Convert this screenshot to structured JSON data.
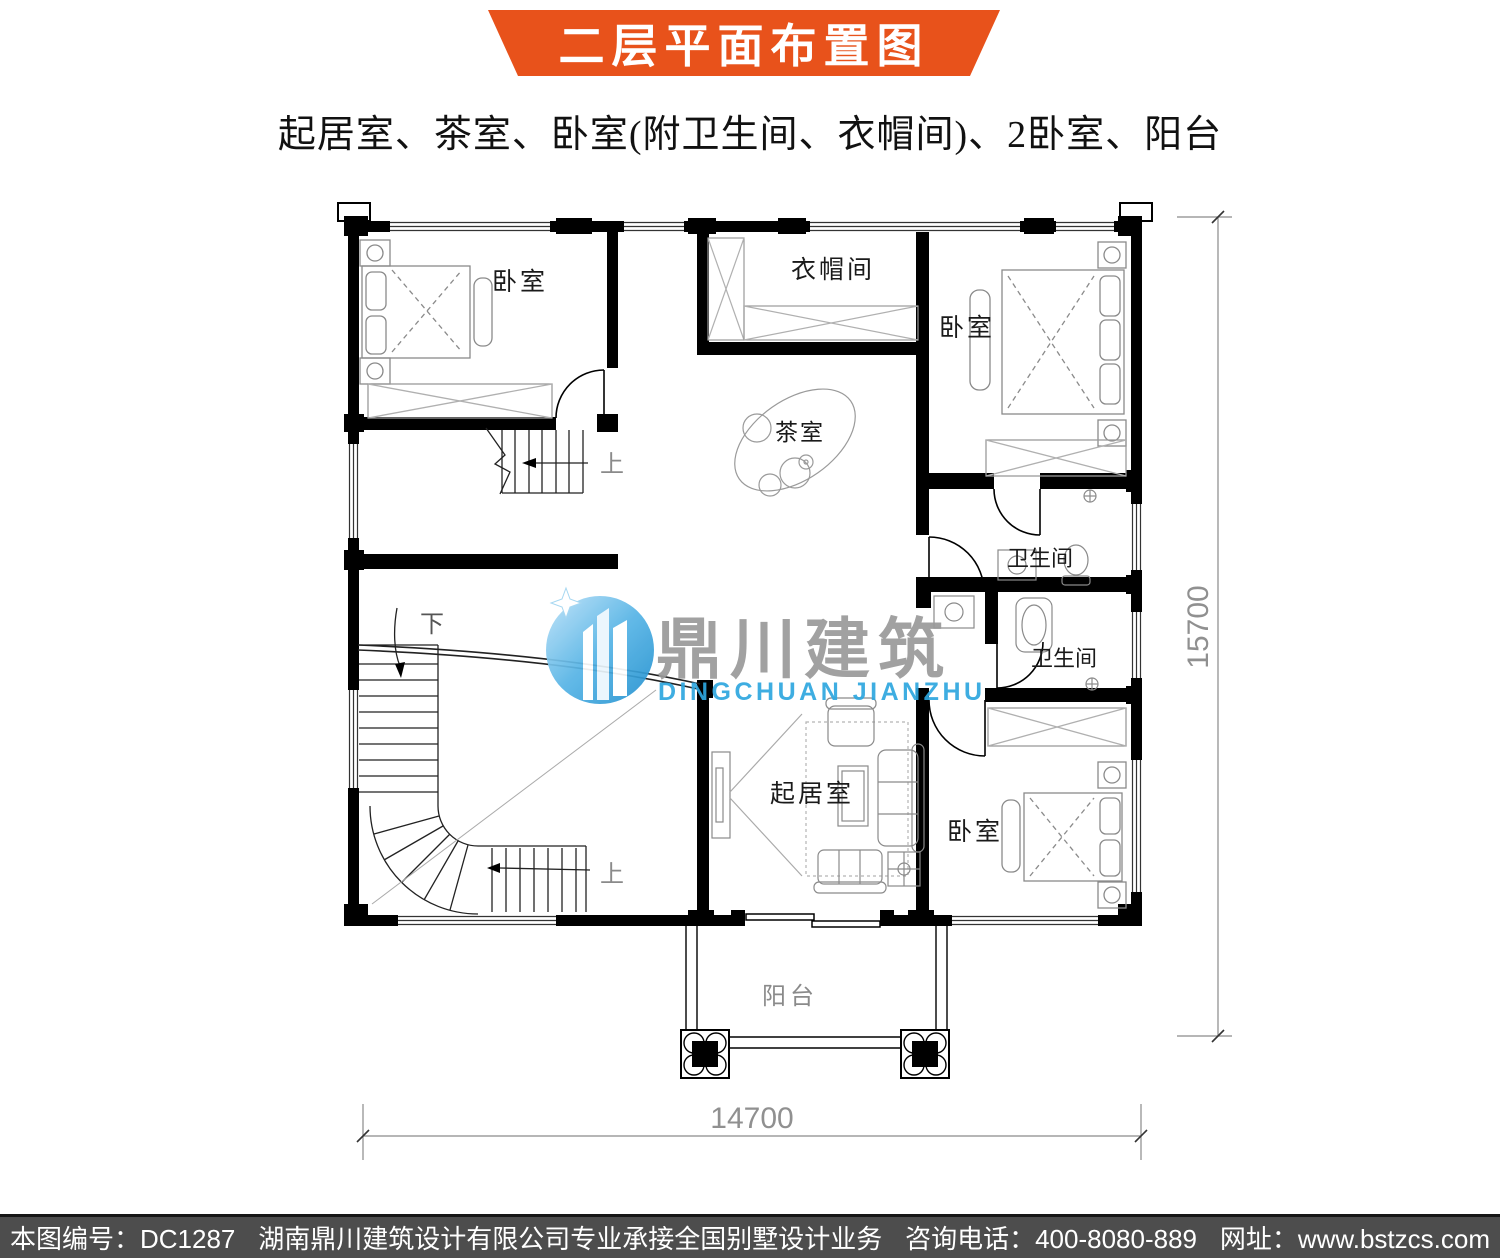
{
  "banner": {
    "title": "二层平面布置图",
    "color": "#e8521b"
  },
  "subtitle": "起居室、茶室、卧室(附卫生间、衣帽间)、2卧室、阳台",
  "watermark": {
    "cn": "鼎川建筑",
    "en": "DINGCHUAN JIANZHU",
    "blue": "#2ea7df",
    "gray": "#9a9a9a"
  },
  "rooms": {
    "bedroom_upper_left": "卧室",
    "cloakroom": "衣帽间",
    "bedroom_upper_right": "卧室",
    "tea_room": "茶室",
    "bathroom_upper": "卫生间",
    "bathroom_lower": "卫生间",
    "living_room": "起居室",
    "bedroom_bottom_right": "卧室",
    "balcony": "阳台"
  },
  "stairs": {
    "down_label": "下",
    "up_label_small": "上",
    "up_label_main": "上"
  },
  "dimensions": {
    "right_height": "15700",
    "bottom_width": "14700"
  },
  "footer": {
    "drawing_no": "本图编号：DC1287",
    "company": "湖南鼎川建筑设计有限公司专业承接全国别墅设计业务",
    "phone": "咨询电话：400-8080-889",
    "website": "网址：www.bstzcs.com"
  }
}
